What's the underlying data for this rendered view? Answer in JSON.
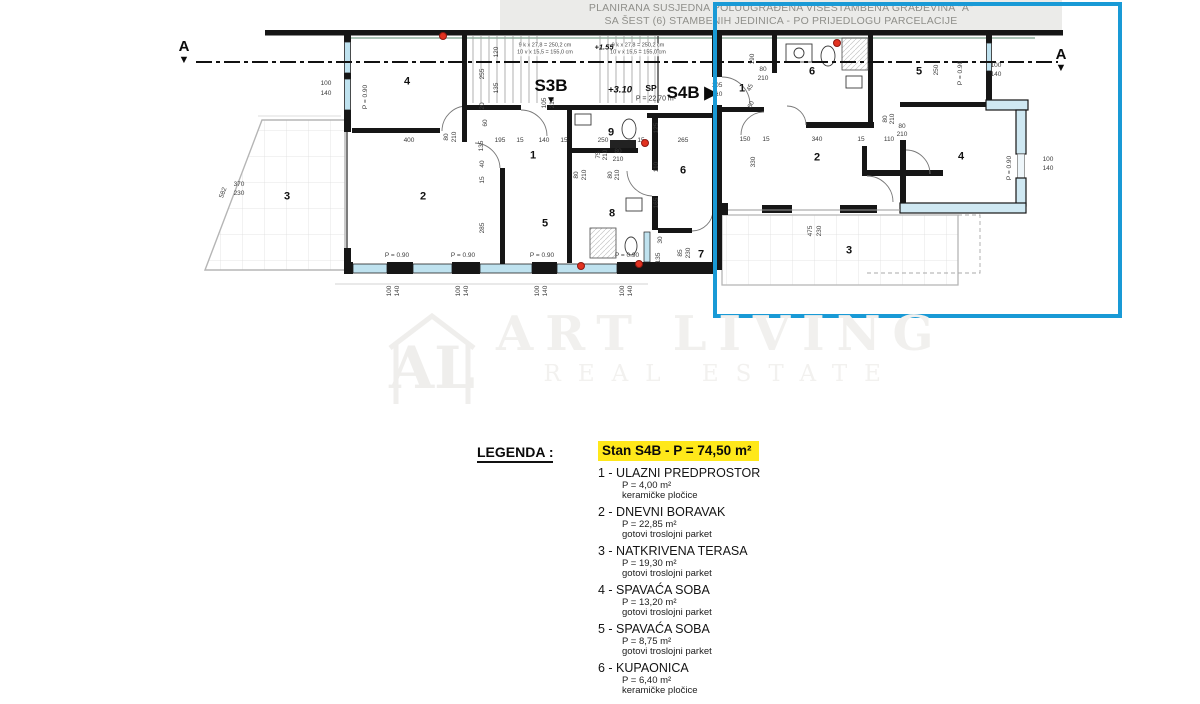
{
  "header": {
    "line1": "PLANIRANA SUSJEDNA POLUUGRAĐENA VIŠESTAMBENA GRAĐEVINA \"A\"",
    "line2": "SA ŠEST (6) STAMBENIH JEDINICA - PO PRIJEDLOGU PARCELACIJE"
  },
  "plan": {
    "section_marker": "A",
    "section_triangle": "▼",
    "unit_left_label": "S3B",
    "unit_left_triangle": "▼",
    "unit_right_label": "S4B ▶",
    "highlight_color": "#199ad6",
    "window_color": "#bfe2ef",
    "labels": [
      {
        "t": "4",
        "x": 407,
        "y": 82,
        "c": "room"
      },
      {
        "t": "3",
        "x": 287,
        "y": 197,
        "c": "room"
      },
      {
        "t": "2",
        "x": 423,
        "y": 197,
        "c": "room"
      },
      {
        "t": "1",
        "x": 533,
        "y": 156,
        "c": "room"
      },
      {
        "t": "5",
        "x": 545,
        "y": 224,
        "c": "room"
      },
      {
        "t": "9",
        "x": 611,
        "y": 133,
        "c": "room"
      },
      {
        "t": "8",
        "x": 612,
        "y": 214,
        "c": "room"
      },
      {
        "t": "6",
        "x": 683,
        "y": 171,
        "c": "room"
      },
      {
        "t": "7",
        "x": 701,
        "y": 255,
        "c": "room"
      },
      {
        "t": "1",
        "x": 742,
        "y": 89,
        "c": "room"
      },
      {
        "t": "6",
        "x": 812,
        "y": 72,
        "c": "room"
      },
      {
        "t": "5",
        "x": 919,
        "y": 72,
        "c": "room"
      },
      {
        "t": "2",
        "x": 817,
        "y": 158,
        "c": "room"
      },
      {
        "t": "4",
        "x": 961,
        "y": 157,
        "c": "room"
      },
      {
        "t": "3",
        "x": 849,
        "y": 251,
        "c": "room"
      },
      {
        "t": "9 k x 27,8 = 250,2 cm",
        "x": 545,
        "y": 46,
        "c": "note"
      },
      {
        "t": "10 v x 15,5 = 155,0 cm",
        "x": 545,
        "y": 53,
        "c": "note"
      },
      {
        "t": "9 k x 27,8 = 250,2 cm",
        "x": 638,
        "y": 46,
        "c": "note"
      },
      {
        "t": "10 v x 15,5 = 155,0 cm",
        "x": 638,
        "y": 53,
        "c": "note"
      },
      {
        "t": "+1.55",
        "x": 604,
        "y": 47,
        "c": "elevs"
      },
      {
        "t": "+3.10",
        "x": 620,
        "y": 90,
        "c": "elev"
      },
      {
        "t": "SP",
        "x": 651,
        "y": 88,
        "c": "sp"
      },
      {
        "t": "P = 22,70 m²",
        "x": 656,
        "y": 99,
        "c": "spa"
      },
      {
        "t": "100",
        "x": 326,
        "y": 84
      },
      {
        "t": "140",
        "x": 326,
        "y": 94
      },
      {
        "t": "P = 0.90",
        "x": 366,
        "y": 97,
        "r": -90
      },
      {
        "t": "582",
        "x": 224,
        "y": 193,
        "r": -70
      },
      {
        "t": "370",
        "x": 239,
        "y": 185
      },
      {
        "t": "230",
        "x": 239,
        "y": 194
      },
      {
        "t": "400",
        "x": 409,
        "y": 141
      },
      {
        "t": "80",
        "x": 447,
        "y": 137,
        "r": -90
      },
      {
        "t": "210",
        "x": 455,
        "y": 137,
        "r": -90
      },
      {
        "t": "135",
        "x": 482,
        "y": 146,
        "r": -90
      },
      {
        "t": "195",
        "x": 500,
        "y": 141
      },
      {
        "t": "15",
        "x": 520,
        "y": 141
      },
      {
        "t": "140",
        "x": 544,
        "y": 141
      },
      {
        "t": "15",
        "x": 564,
        "y": 141
      },
      {
        "t": "250",
        "x": 603,
        "y": 141
      },
      {
        "t": "15",
        "x": 641,
        "y": 141
      },
      {
        "t": "265",
        "x": 683,
        "y": 141
      },
      {
        "t": "120",
        "x": 497,
        "y": 52,
        "r": -90
      },
      {
        "t": "255",
        "x": 483,
        "y": 74,
        "r": -90
      },
      {
        "t": "135",
        "x": 497,
        "y": 88,
        "r": -90
      },
      {
        "t": "20",
        "x": 483,
        "y": 106,
        "r": -90
      },
      {
        "t": "60",
        "x": 486,
        "y": 123,
        "r": -90
      },
      {
        "t": "40",
        "x": 483,
        "y": 164,
        "r": -90
      },
      {
        "t": "15",
        "x": 483,
        "y": 180,
        "r": -90
      },
      {
        "t": "285",
        "x": 483,
        "y": 228,
        "r": -90
      },
      {
        "t": "105",
        "x": 545,
        "y": 103,
        "r": -90
      },
      {
        "t": "210",
        "x": 553,
        "y": 103,
        "r": -90
      },
      {
        "t": "75",
        "x": 599,
        "y": 155,
        "r": -90
      },
      {
        "t": "210",
        "x": 606,
        "y": 155,
        "r": -90
      },
      {
        "t": "80",
        "x": 618,
        "y": 152
      },
      {
        "t": "210",
        "x": 618,
        "y": 160
      },
      {
        "t": "80",
        "x": 577,
        "y": 175,
        "r": -90
      },
      {
        "t": "210",
        "x": 585,
        "y": 175,
        "r": -90
      },
      {
        "t": "80",
        "x": 611,
        "y": 175,
        "r": -90
      },
      {
        "t": "210",
        "x": 618,
        "y": 175,
        "r": -90
      },
      {
        "t": "125",
        "x": 657,
        "y": 128,
        "r": -90
      },
      {
        "t": "110",
        "x": 657,
        "y": 167,
        "r": -90
      },
      {
        "t": "165",
        "x": 657,
        "y": 203,
        "r": -90
      },
      {
        "t": "30",
        "x": 661,
        "y": 240,
        "r": -90
      },
      {
        "t": "135",
        "x": 659,
        "y": 258,
        "r": -90
      },
      {
        "t": "85",
        "x": 681,
        "y": 253,
        "r": -90
      },
      {
        "t": "230",
        "x": 689,
        "y": 253,
        "r": -90
      },
      {
        "t": "P = 0.90",
        "x": 397,
        "y": 256
      },
      {
        "t": "P = 0.90",
        "x": 463,
        "y": 256
      },
      {
        "t": "P = 0.90",
        "x": 542,
        "y": 256
      },
      {
        "t": "P = 0.90",
        "x": 627,
        "y": 256
      },
      {
        "t": "100",
        "x": 390,
        "y": 291,
        "r": -90
      },
      {
        "t": "140",
        "x": 398,
        "y": 291,
        "r": -90
      },
      {
        "t": "100",
        "x": 459,
        "y": 291,
        "r": -90
      },
      {
        "t": "140",
        "x": 467,
        "y": 291,
        "r": -90
      },
      {
        "t": "100",
        "x": 538,
        "y": 291,
        "r": -90
      },
      {
        "t": "140",
        "x": 546,
        "y": 291,
        "r": -90
      },
      {
        "t": "100",
        "x": 623,
        "y": 291,
        "r": -90
      },
      {
        "t": "140",
        "x": 631,
        "y": 291,
        "r": -90
      },
      {
        "t": "190",
        "x": 753,
        "y": 59,
        "r": -90
      },
      {
        "t": "80",
        "x": 763,
        "y": 70
      },
      {
        "t": "210",
        "x": 763,
        "y": 79
      },
      {
        "t": "105",
        "x": 717,
        "y": 86
      },
      {
        "t": "210",
        "x": 717,
        "y": 95
      },
      {
        "t": "45",
        "x": 751,
        "y": 88,
        "r": -65
      },
      {
        "t": "60",
        "x": 752,
        "y": 105,
        "r": -65
      },
      {
        "t": "150",
        "x": 745,
        "y": 140
      },
      {
        "t": "15",
        "x": 766,
        "y": 140
      },
      {
        "t": "340",
        "x": 817,
        "y": 140
      },
      {
        "t": "15",
        "x": 861,
        "y": 140
      },
      {
        "t": "110",
        "x": 889,
        "y": 140
      },
      {
        "t": "330",
        "x": 754,
        "y": 162,
        "r": -90
      },
      {
        "t": "80",
        "x": 886,
        "y": 119,
        "r": -90
      },
      {
        "t": "210",
        "x": 893,
        "y": 119,
        "r": -90
      },
      {
        "t": "80",
        "x": 902,
        "y": 127
      },
      {
        "t": "210",
        "x": 902,
        "y": 135
      },
      {
        "t": "250",
        "x": 937,
        "y": 70,
        "r": -90
      },
      {
        "t": "P = 0.90",
        "x": 961,
        "y": 73,
        "r": -90
      },
      {
        "t": "100",
        "x": 996,
        "y": 66
      },
      {
        "t": "140",
        "x": 996,
        "y": 75
      },
      {
        "t": "P = 0.90",
        "x": 1010,
        "y": 168,
        "r": -90
      },
      {
        "t": "100",
        "x": 1048,
        "y": 160
      },
      {
        "t": "140",
        "x": 1048,
        "y": 169
      },
      {
        "t": "475",
        "x": 811,
        "y": 231,
        "r": -90
      },
      {
        "t": "230",
        "x": 820,
        "y": 231,
        "r": -90
      }
    ],
    "markers": [
      {
        "x": 443,
        "y": 36
      },
      {
        "x": 837,
        "y": 43
      },
      {
        "x": 645,
        "y": 143
      },
      {
        "x": 581,
        "y": 266
      },
      {
        "x": 639,
        "y": 264
      }
    ]
  },
  "watermark": {
    "logo": "AL",
    "line1": "ART LIVING",
    "line2": "REAL ESTATE"
  },
  "legend": {
    "heading": "LEGENDA :",
    "title": "Stan S4B  -  P = 74,50 m²",
    "title_bg": "#ffe81a",
    "items": [
      {
        "num": "1",
        "name": "ULAZNI PREDPROSTOR",
        "area": "P = 4,00 m²",
        "floor": "keramičke pločice"
      },
      {
        "num": "2",
        "name": "DNEVNI BORAVAK",
        "area": "P = 22,85 m²",
        "floor": "gotovi troslojni parket"
      },
      {
        "num": "3",
        "name": "NATKRIVENA TERASA",
        "area": "P = 19,30 m²",
        "floor": "gotovi troslojni parket"
      },
      {
        "num": "4",
        "name": "SPAVAĆA SOBA",
        "area": "P = 13,20 m²",
        "floor": "gotovi troslojni parket"
      },
      {
        "num": "5",
        "name": "SPAVAĆA SOBA",
        "area": "P = 8,75 m²",
        "floor": "gotovi troslojni parket"
      },
      {
        "num": "6",
        "name": "KUPAONICA",
        "area": "P = 6,40 m²",
        "floor": "keramičke pločice"
      }
    ]
  }
}
